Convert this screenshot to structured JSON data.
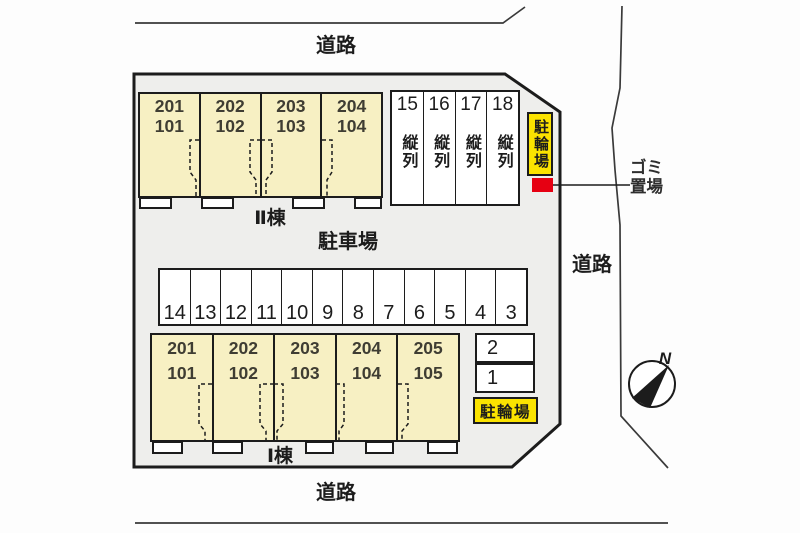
{
  "roads": {
    "top": "道路",
    "right": "道路",
    "bottom": "道路"
  },
  "site": {
    "parking_lot_label": "駐車場",
    "bicycle_parking_top": "駐輪場",
    "bicycle_parking_bottom": "駐輪場",
    "garbage_line1": "ゴミ",
    "garbage_line2": "置場",
    "north_label": "N"
  },
  "building_2": {
    "name": "Ⅱ棟",
    "units": [
      {
        "upper": "201",
        "lower": "101"
      },
      {
        "upper": "202",
        "lower": "102"
      },
      {
        "upper": "203",
        "lower": "103"
      },
      {
        "upper": "204",
        "lower": "104"
      }
    ]
  },
  "building_1": {
    "name": "Ⅰ棟",
    "units": [
      {
        "upper": "201",
        "lower": "101"
      },
      {
        "upper": "202",
        "lower": "102"
      },
      {
        "upper": "203",
        "lower": "103"
      },
      {
        "upper": "204",
        "lower": "104"
      },
      {
        "upper": "205",
        "lower": "105"
      }
    ]
  },
  "tandem_spaces": [
    {
      "number": "15",
      "label": "縦列"
    },
    {
      "number": "16",
      "label": "縦列"
    },
    {
      "number": "17",
      "label": "縦列"
    },
    {
      "number": "18",
      "label": "縦列"
    }
  ],
  "parking_row_spaces": [
    "14",
    "13",
    "12",
    "11",
    "10",
    "9",
    "8",
    "7",
    "6",
    "5",
    "4",
    "3"
  ],
  "side_spaces": [
    "2",
    "1"
  ],
  "colors": {
    "plot_fill": "#eeeeec",
    "building_fill": "#f7f0c3",
    "highlight_yellow": "#fbe300",
    "garbage_red": "#e60012",
    "line": "#1c1c1c"
  }
}
